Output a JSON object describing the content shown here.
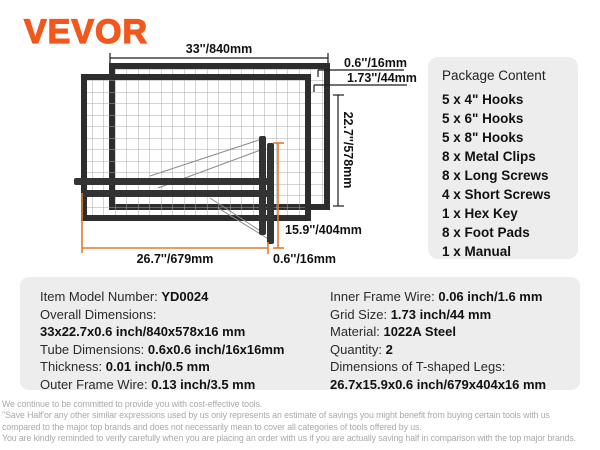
{
  "brand": {
    "logo": "VEVOR"
  },
  "colors": {
    "brand_orange": "#f2571c",
    "dimension_orange": "#e6792e",
    "panel_gray": "#ededed",
    "frame_dark": "#2d2d2d",
    "disclaimer_gray": "#a9a9a9"
  },
  "diagram": {
    "dim_width": "33''/840mm",
    "dim_tube_top": "0.6''/16mm",
    "dim_grid": "1.73''/44mm",
    "dim_height": "22.7''/578mm",
    "dim_leg_width": "15.9''/404mm",
    "dim_leg_length": "26.7''/679mm",
    "dim_tube_bottom": "0.6''/16mm"
  },
  "package_content": {
    "title": "Package Content",
    "items": [
      "5 x 4\" Hooks",
      "5 x 6\" Hooks",
      "5 x 8\" Hooks",
      "8 x Metal Clips",
      "8 x Long Screws",
      "4 x Short Screws",
      "1 x Hex Key",
      "8 x Foot Pads",
      "1 x Manual"
    ]
  },
  "specs": {
    "left": [
      {
        "label": "Item Model Number: ",
        "value": "YD0024"
      },
      {
        "label": "Overall Dimensions:",
        "value": ""
      },
      {
        "label": "",
        "value": "33x22.7x0.6 inch/840x578x16 mm"
      },
      {
        "label": "Tube Dimensions: ",
        "value": "0.6x0.6 inch/16x16mm"
      },
      {
        "label": "Thickness: ",
        "value": "0.01 inch/0.5 mm"
      },
      {
        "label": "Outer Frame Wire: ",
        "value": "0.13 inch/3.5 mm"
      }
    ],
    "right": [
      {
        "label": "Inner Frame Wire: ",
        "value": "0.06 inch/1.6 mm"
      },
      {
        "label": "Grid Size: ",
        "value": "1.73 inch/44 mm"
      },
      {
        "label": "Material: ",
        "value": "1022A Steel"
      },
      {
        "label": "Quantity: ",
        "value": "2"
      },
      {
        "label": "Dimensions of T-shaped Legs:",
        "value": ""
      },
      {
        "label": "",
        "value": "26.7x15.9x0.6 inch/679x404x16 mm"
      }
    ]
  },
  "disclaimer": {
    "lines": [
      "We continue to be committed to provide you with cost-effective tools.",
      "''Save Half'or any other similar expressions used by us only represents an estimate of savings you might benefit from buying certain tools with us",
      "compared to the major top brands and does not necessarily mean to cover all categories of tools offered by us.",
      "You are kindly reminded to verify carefully when you are placing an order with us if you are actually saving half in comparison with the top major brands."
    ]
  }
}
